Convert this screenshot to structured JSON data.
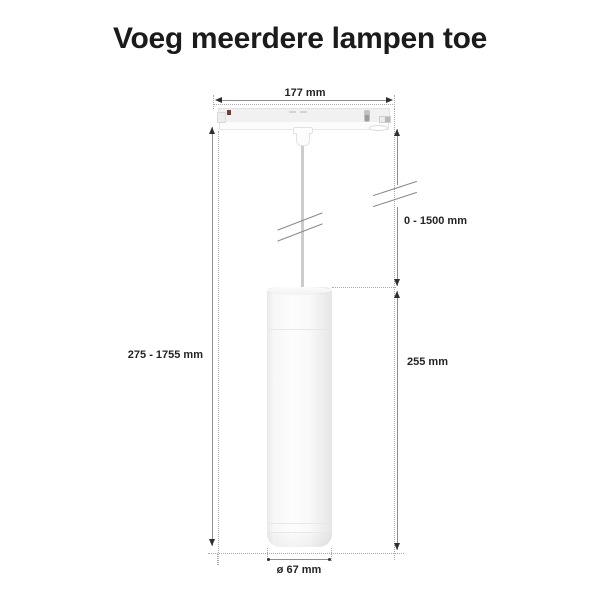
{
  "title": "Voeg meerdere lampen toe",
  "diagram": {
    "labels": {
      "track_width": "177 mm",
      "suspension_range": "0 - 1500 mm",
      "overall_range": "275 - 1755 mm",
      "lamp_height": "255 mm",
      "lamp_diameter": "ø 67 mm"
    },
    "colors": {
      "dimension_line": "#8f8f8f",
      "extension_line": "#ababab",
      "label_text": "#242424",
      "track_indicator_dot": "#6e4138",
      "lamp_body": "#f6f6f6",
      "cord": "#cccccc"
    }
  }
}
